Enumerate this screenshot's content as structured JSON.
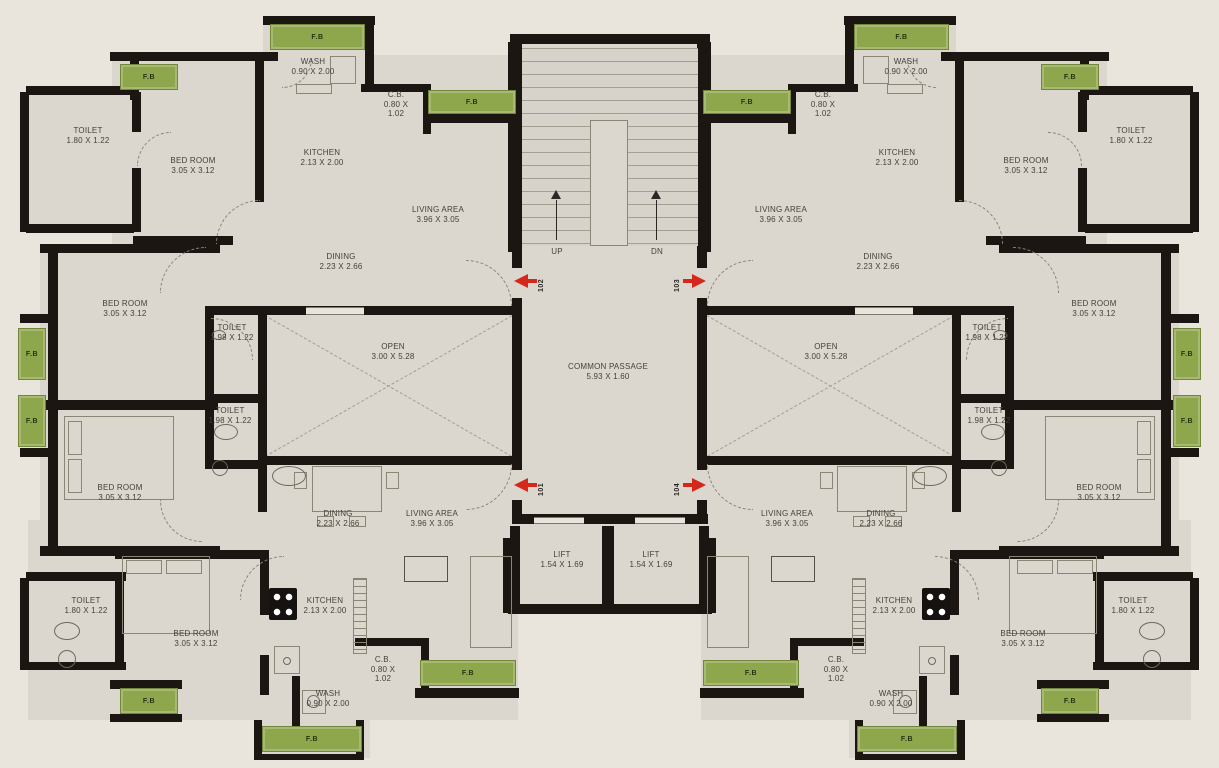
{
  "plan_title": "apartment-typical-floor-plan",
  "labels": {
    "fb": "F.B",
    "up": "UP",
    "dn": "DN"
  },
  "colors": {
    "wall": "#1b1611",
    "floor": "#dbd7cf",
    "background": "#e9e5dd",
    "planter_green": "#8ea74d",
    "door_arrow_red": "#d6281a"
  },
  "rooms": [
    {
      "id": "toilet-top-left",
      "lines": [
        "TOILET",
        "1.80 X 1.22"
      ],
      "x": 88,
      "y": 126,
      "mirror": true
    },
    {
      "id": "bedroom-top-left",
      "lines": [
        "BED ROOM",
        "3.05 X 3.12"
      ],
      "x": 193,
      "y": 156,
      "mirror": true
    },
    {
      "id": "kitchen-top-left",
      "lines": [
        "KITCHEN",
        "2.13 X 2.00"
      ],
      "x": 322,
      "y": 148,
      "mirror": true
    },
    {
      "id": "wash-top-left",
      "lines": [
        "WASH",
        "0.90 X 2.00"
      ],
      "x": 313,
      "y": 57,
      "mirror": true
    },
    {
      "id": "cb-top-left",
      "lines": [
        "C.B.",
        "0.80 X",
        "1.02"
      ],
      "x": 396,
      "y": 90,
      "mirror": true
    },
    {
      "id": "living-area-top-left",
      "lines": [
        "LIVING AREA",
        "3.96 X 3.05"
      ],
      "x": 438,
      "y": 205,
      "mirror": true
    },
    {
      "id": "dining-top-left",
      "lines": [
        "DINING",
        "2.23 X 2.66"
      ],
      "x": 341,
      "y": 252,
      "mirror": true
    },
    {
      "id": "bedroom-mid-upper-left",
      "lines": [
        "BED ROOM",
        "3.05 X 3.12"
      ],
      "x": 125,
      "y": 299,
      "mirror": true
    },
    {
      "id": "toilet-mid-upper-left",
      "lines": [
        "TOILET",
        "1.98 X 1.22"
      ],
      "x": 232,
      "y": 323,
      "mirror": true
    },
    {
      "id": "open-area-left",
      "lines": [
        "OPEN",
        "3.00 X 5.28"
      ],
      "x": 393,
      "y": 342,
      "mirror": true
    },
    {
      "id": "toilet-mid-lower-left",
      "lines": [
        "TOILET",
        "1.98 X 1.22"
      ],
      "x": 230,
      "y": 406,
      "mirror": true
    },
    {
      "id": "bedroom-mid-lower-left",
      "lines": [
        "BED ROOM",
        "3.05 X 3.12"
      ],
      "x": 120,
      "y": 483,
      "mirror": true
    },
    {
      "id": "dining-bottom-left",
      "lines": [
        "DINING",
        "2.23 X 2.66"
      ],
      "x": 338,
      "y": 509,
      "mirror": true
    },
    {
      "id": "living-area-bottom-left",
      "lines": [
        "LIVING AREA",
        "3.96 X 3.05"
      ],
      "x": 432,
      "y": 509,
      "mirror": true
    },
    {
      "id": "toilet-bottom-left",
      "lines": [
        "TOILET",
        "1.80 X 1.22"
      ],
      "x": 86,
      "y": 596,
      "mirror": true
    },
    {
      "id": "bedroom-bottom-left",
      "lines": [
        "BED ROOM",
        "3.05 X 3.12"
      ],
      "x": 196,
      "y": 629,
      "mirror": true
    },
    {
      "id": "kitchen-bottom-left",
      "lines": [
        "KITCHEN",
        "2.13 X 2.00"
      ],
      "x": 325,
      "y": 596,
      "mirror": true
    },
    {
      "id": "cb-bottom-left",
      "lines": [
        "C.B.",
        "0.80 X",
        "1.02"
      ],
      "x": 383,
      "y": 655,
      "mirror": true
    },
    {
      "id": "wash-bottom-left",
      "lines": [
        "WASH",
        "0.90 X 2.00"
      ],
      "x": 328,
      "y": 689,
      "mirror": true
    },
    {
      "id": "common-passage",
      "lines": [
        "COMMON PASSAGE",
        "5.93 X 1.60"
      ],
      "x": 608,
      "y": 362,
      "mirror": false
    },
    {
      "id": "lift-left",
      "lines": [
        "LIFT",
        "1.54 X 1.69"
      ],
      "x": 562,
      "y": 550,
      "mirror": false
    },
    {
      "id": "lift-right",
      "lines": [
        "LIFT",
        "1.54 X 1.69"
      ],
      "x": 651,
      "y": 550,
      "mirror": false
    },
    {
      "id": "stair-up",
      "lines": [
        "UP"
      ],
      "x": 557,
      "y": 247,
      "mirror": false
    },
    {
      "id": "stair-dn",
      "lines": [
        "DN"
      ],
      "x": 657,
      "y": 247,
      "mirror": false
    }
  ],
  "doors": [
    {
      "number": "102",
      "y": 274,
      "dir": "left"
    },
    {
      "number": "103",
      "y": 274,
      "dir": "right"
    },
    {
      "number": "101",
      "y": 478,
      "dir": "left"
    },
    {
      "number": "104",
      "y": 478,
      "dir": "right"
    }
  ]
}
